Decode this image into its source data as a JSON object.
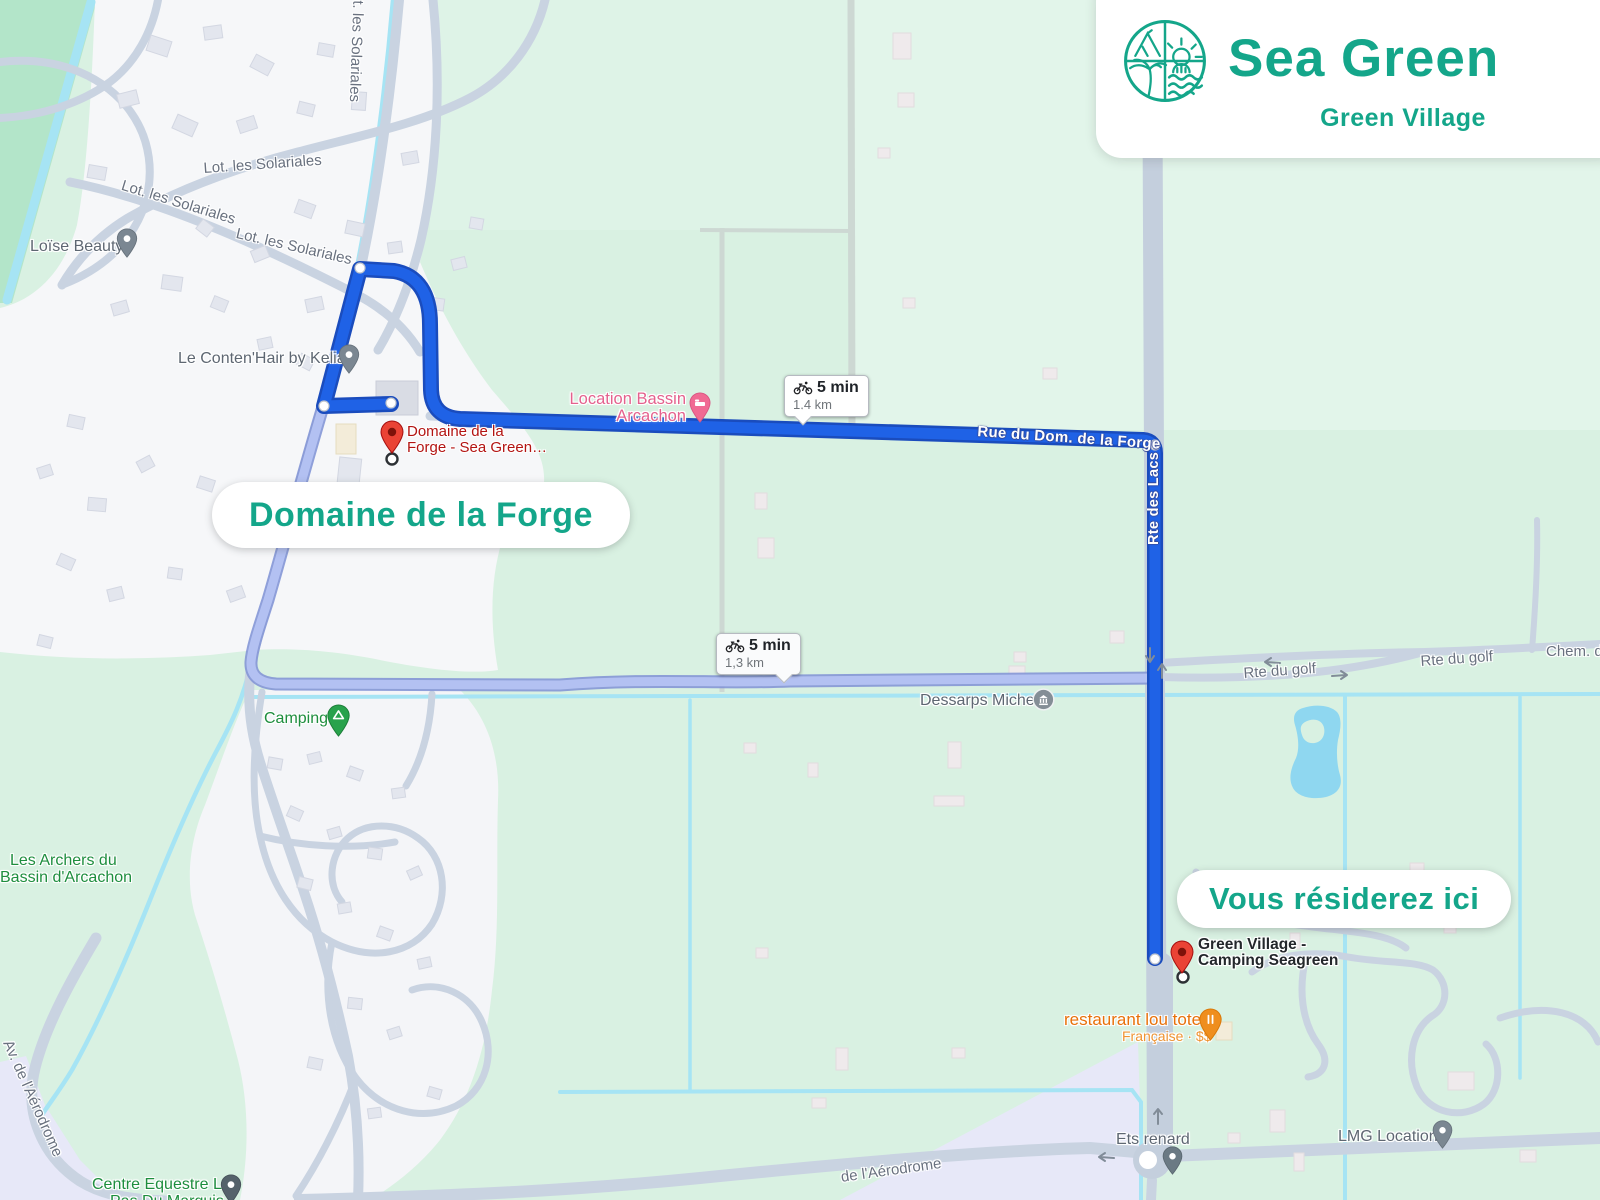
{
  "brand": {
    "name": "Sea Green",
    "subtitle": "Green Village"
  },
  "callouts": {
    "origin_pill": "Domaine de la Forge",
    "destination_pill": "Vous résiderez ici"
  },
  "route_badges": {
    "primary": {
      "mode": "bicycle",
      "duration": "5 min",
      "distance": "1,4 km"
    },
    "alternate": {
      "mode": "bicycle",
      "duration": "5 min",
      "distance": "1,3 km"
    }
  },
  "route_street_labels": {
    "horizontal": "Rue du Dom. de la Forge",
    "vertical": "Rte des Lacs"
  },
  "markers": {
    "origin": {
      "line1": "Domaine de la",
      "line2": "Forge - Sea Green…"
    },
    "destination": {
      "line1": "Green Village -",
      "line2": "Camping Seagreen"
    }
  },
  "labels": [
    {
      "kind": "road",
      "text": "Lot. les Solariales"
    },
    {
      "kind": "road",
      "text": "Lot. les Solariales"
    },
    {
      "kind": "road",
      "text": "Lot. les Solariales"
    },
    {
      "kind": "road",
      "text": "Lot. les Solariales"
    },
    {
      "kind": "poi",
      "text": "Loïse Beauty"
    },
    {
      "kind": "poi",
      "text": "Le Conten'Hair by Kelian"
    },
    {
      "kind": "lodging",
      "text": "Location Bassin"
    },
    {
      "kind": "lodging",
      "text": "Arcachon"
    },
    {
      "kind": "park",
      "text": "Camping"
    },
    {
      "kind": "park",
      "text": "Les Archers du"
    },
    {
      "kind": "park",
      "text": "Bassin d'Arcachon"
    },
    {
      "kind": "poi",
      "text": "Dessarps Michel"
    },
    {
      "kind": "road",
      "text": "Rte du golf"
    },
    {
      "kind": "road",
      "text": "Rte du golf"
    },
    {
      "kind": "road",
      "text": "Chem. d"
    },
    {
      "kind": "restaurant",
      "text": "restaurant lou totem"
    },
    {
      "kind": "restaurant-sub",
      "text": "Française · $$"
    },
    {
      "kind": "poi",
      "text": "Ets renard"
    },
    {
      "kind": "poi",
      "text": "LMG Location"
    },
    {
      "kind": "park",
      "text": "Centre Equestre Le"
    },
    {
      "kind": "park",
      "text": "Pas Du Marquis"
    },
    {
      "kind": "road",
      "text": "Av. de l'Aérodrome"
    },
    {
      "kind": "road",
      "text": "de l'Aérodrome"
    }
  ],
  "icons": {
    "route_mode": "bicycle-icon",
    "origin_marker": "red-pin-icon",
    "destination_marker": "red-pin-icon",
    "brand_logo": "beach-camp-sun-waves-icon"
  },
  "colors": {
    "brand_teal": "#14a68a",
    "route_primary": "#1f62e6",
    "route_primary_casing": "#1a4cbd",
    "route_alternate": "#b3c1f2",
    "route_alternate_casing": "#8496d6",
    "water": "#a6e4f4",
    "marker_red": "#ea4335"
  }
}
